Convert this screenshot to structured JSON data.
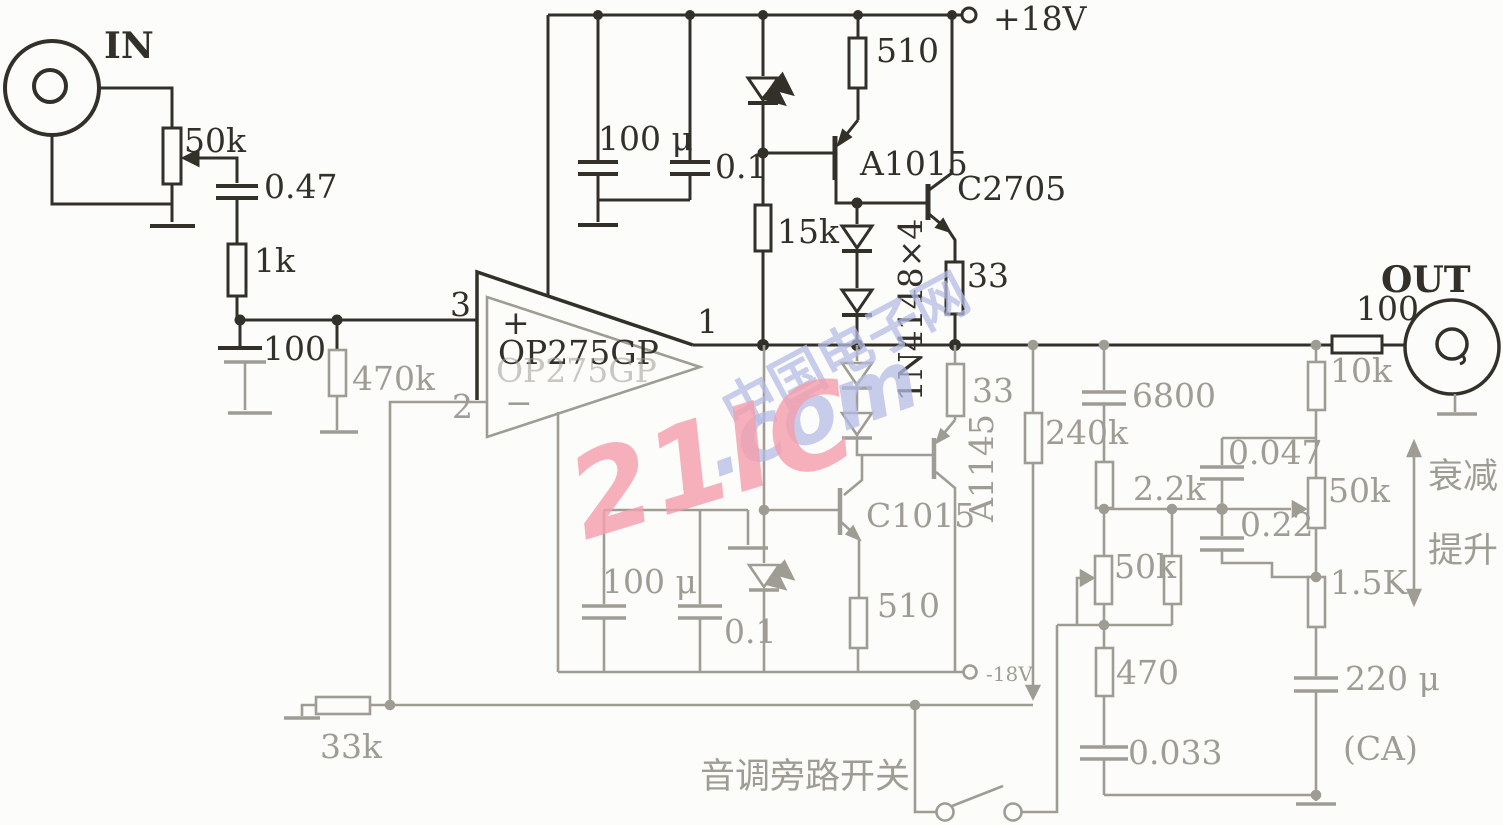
{
  "io": {
    "in": "IN",
    "out": "OUT"
  },
  "power": {
    "positive": "+18V",
    "negative": "-18V"
  },
  "opamp": {
    "name": "OP275GP",
    "pin_in_plus": "3",
    "pin_in_minus": "2",
    "pin_out": "1",
    "plus": "+",
    "minus": "−"
  },
  "components": {
    "pot_in": "50k",
    "cap_in": "0.47",
    "r_series_in": "1k",
    "cap_shunt_in": "100",
    "r_bias": "470k",
    "cap_bulk_top": "100 μ",
    "cap_bypass_top": "0.1",
    "r_led_bias_top": "15k",
    "r_emitter_top": "510",
    "q_pnp_top": "A1015",
    "q_npn_top": "C2705",
    "r_out_top": "33",
    "diode_chain": "1N4148×4",
    "cap_bulk_bot": "100 μ",
    "cap_bypass_bot": "0.1",
    "q_npn_bot": "C1015",
    "r_emitter_bot": "510",
    "r_out_bot": "33",
    "q_pnp_bot": "A1145",
    "r_feedback": "240k",
    "cap_bass_in": "6800",
    "r_bass": "2.2k",
    "pot_bass": "50k",
    "r_bass_lower": "470",
    "cap_bass_out": "0.033",
    "r_ground_leg": "33k",
    "r_isolation_out": "100",
    "r_treble_in": "10k",
    "cap_treble_in": "0.047",
    "pot_treble": "50k",
    "cap_treble_mid": "0.22",
    "r_treble_out": "1.5K",
    "cap_out_ground": "220 μ"
  },
  "annotations": {
    "tone_bypass_switch": "音调旁路开关",
    "attenuate": "衰减",
    "boost": "提升",
    "channel": "(CA)"
  },
  "watermark": {
    "brand": "21IC",
    "domain": ".com",
    "site": "中国电子网"
  }
}
